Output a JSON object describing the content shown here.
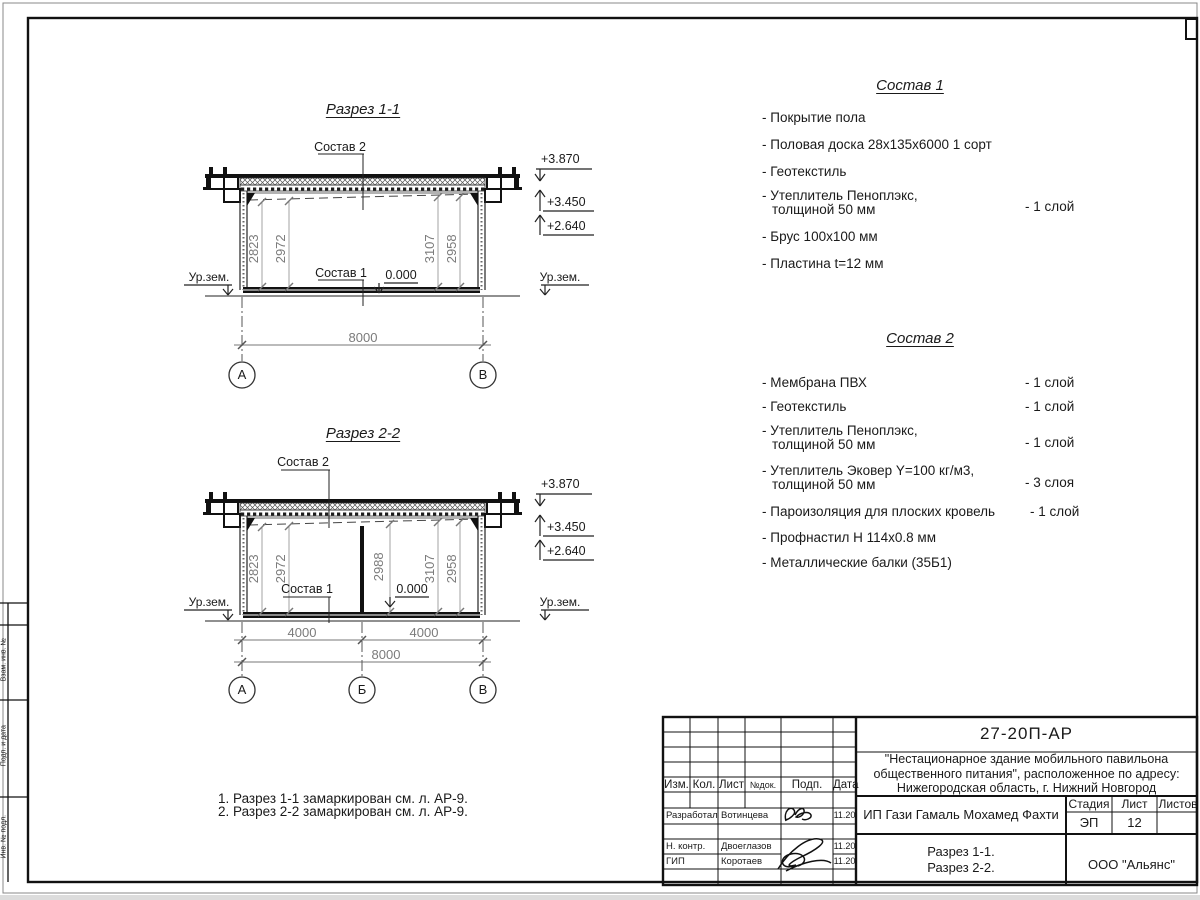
{
  "sections": {
    "s1": {
      "title": "Разрез 1-1",
      "sostav2_label": "Состав 2",
      "sostav1_label": "Состав 1",
      "zero_mark": "0.000",
      "ground_left": "Ур.зем.",
      "ground_right": "Ур.зем.",
      "elevations": [
        "+3.870",
        "+3.450",
        "+2.640"
      ],
      "dims_vertical": [
        "2823",
        "2972",
        "3107",
        "2958"
      ],
      "dim_total": "8000",
      "axes": [
        "А",
        "В"
      ]
    },
    "s2": {
      "title": "Разрез 2-2",
      "sostav2_label": "Состав 2",
      "sostav1_label": "Состав 1",
      "zero_mark": "0.000",
      "ground_left": "Ур.зем.",
      "ground_right": "Ур.зем.",
      "elevations": [
        "+3.870",
        "+3.450",
        "+2.640"
      ],
      "dims_vertical": [
        "2823",
        "2972",
        "2988",
        "3107",
        "2958"
      ],
      "dim_spans": [
        "4000",
        "4000"
      ],
      "dim_total": "8000",
      "axes": [
        "А",
        "Б",
        "В"
      ]
    }
  },
  "sostav1": {
    "title": "Состав 1",
    "items": [
      {
        "text": "- Покрытие пола"
      },
      {
        "text": "- Половая доска 28х135х6000 1 сорт"
      },
      {
        "text": "- Геотекстиль"
      },
      {
        "text": "- Утеплитель Пеноплэкс,",
        "text2": "толщиной 50 мм",
        "qty": "- 1 слой"
      },
      {
        "text": "- Брус 100х100 мм"
      },
      {
        "text": "- Пластина t=12 мм"
      }
    ]
  },
  "sostav2": {
    "title": "Состав 2",
    "items": [
      {
        "text": "- Мембрана ПВХ",
        "qty": "- 1 слой"
      },
      {
        "text": "- Геотекстиль",
        "qty": "- 1 слой"
      },
      {
        "text": "- Утеплитель Пеноплэкс,",
        "text2": "толщиной 50 мм",
        "qty": "- 1 слой"
      },
      {
        "text": "- Утеплитель Эковер Y=100 кг/м3,",
        "text2": "толщиной 50 мм",
        "qty": "- 3 слоя"
      },
      {
        "text": "- Пароизоляция для плоских кровель",
        "qty": "- 1 слой"
      },
      {
        "text": "- Профнастил Н 114х0.8 мм"
      },
      {
        "text": "- Металлические балки (35Б1)"
      }
    ]
  },
  "notes": {
    "line1": "1. Разрез 1-1 замаркирован см. л. АР-9.",
    "line2": "2. Разрез 2-2 замаркирован см. л. АР-9."
  },
  "stamp": {
    "doc_number": "27-20П-АР",
    "project": {
      "line1": "\"Нестационарное здание мобильного павильона",
      "line2": "общественного питания\", расположенное по адресу:",
      "line3": "Нижегородская область, г. Нижний Новгород"
    },
    "columns": {
      "izm": "Изм.",
      "kol": "Кол.",
      "list": "Лист",
      "ndok": "№док.",
      "podp": "Подп.",
      "data": "Дата"
    },
    "signers": [
      {
        "role": "Разработал",
        "name": "Вотинцева",
        "date": "11.20"
      },
      {
        "role": "Н. контр.",
        "name": "Двоеглазов",
        "date": "11.20"
      },
      {
        "role": "ГИП",
        "name": "Коротаев",
        "date": "11.20"
      }
    ],
    "client": "ИП Гази Гамаль Мохамед Фахти",
    "stage": {
      "label": "Стадия",
      "value": "ЭП"
    },
    "sheet": {
      "label": "Лист",
      "value": "12"
    },
    "sheets": {
      "label": "Листов",
      "value": ""
    },
    "titles": {
      "line1": "Разрез 1-1.",
      "line2": "Разрез 2-2."
    },
    "company": "ООО \"Альянс\""
  },
  "frame": {
    "side_labels": {
      "a": "Взам. инв. №",
      "b": "Подп. и дата",
      "c": "Инв. № подл."
    }
  }
}
